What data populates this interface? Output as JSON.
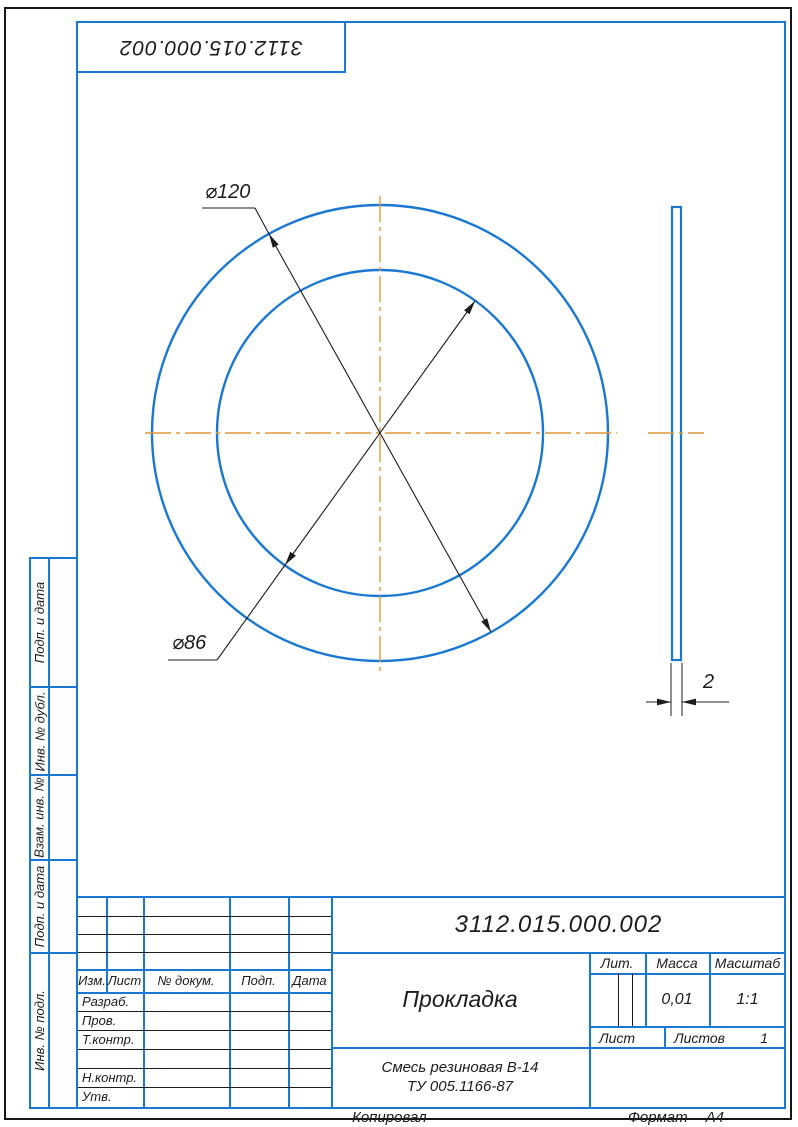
{
  "stamp": {
    "designation_rotated": "3112.015.000.002"
  },
  "drawing": {
    "outer_diameter_label": "⌀120",
    "inner_diameter_label": "⌀86",
    "thickness_label": "2",
    "colors": {
      "line_blue": "#1b78d2",
      "centerline_orange": "#e2993b",
      "dim_black": "#1c1c1c"
    }
  },
  "side_columns": {
    "items": [
      "Подп. и дата",
      "Инв. № дубл.",
      "Взам. инв. №",
      "Подп. и дата",
      "Инв. № подл."
    ]
  },
  "title_block": {
    "designation": "3112.015.000.002",
    "part_name": "Прокладка",
    "material_line1": "Смесь резиновая В-14",
    "material_line2": "ТУ 005.1166-87",
    "headers": {
      "izm": "Изм.",
      "list": "Лист",
      "doc": "№ докум.",
      "podp": "Подп.",
      "data": "Дата"
    },
    "rows": {
      "razrab": "Разраб.",
      "prov": "Пров.",
      "tkontr": "Т.контр.",
      "nkontr": "Н.контр.",
      "utv": "Утв."
    },
    "lit_label": "Лит.",
    "mass_label": "Масса",
    "scale_label": "Масштаб",
    "mass_value": "0,01",
    "scale_value": "1:1",
    "sheet_label": "Лист",
    "sheets_label": "Листов",
    "sheets_value": "1"
  },
  "footer": {
    "copied": "Копировал",
    "format_label": "Формат",
    "format_value": "А4"
  }
}
